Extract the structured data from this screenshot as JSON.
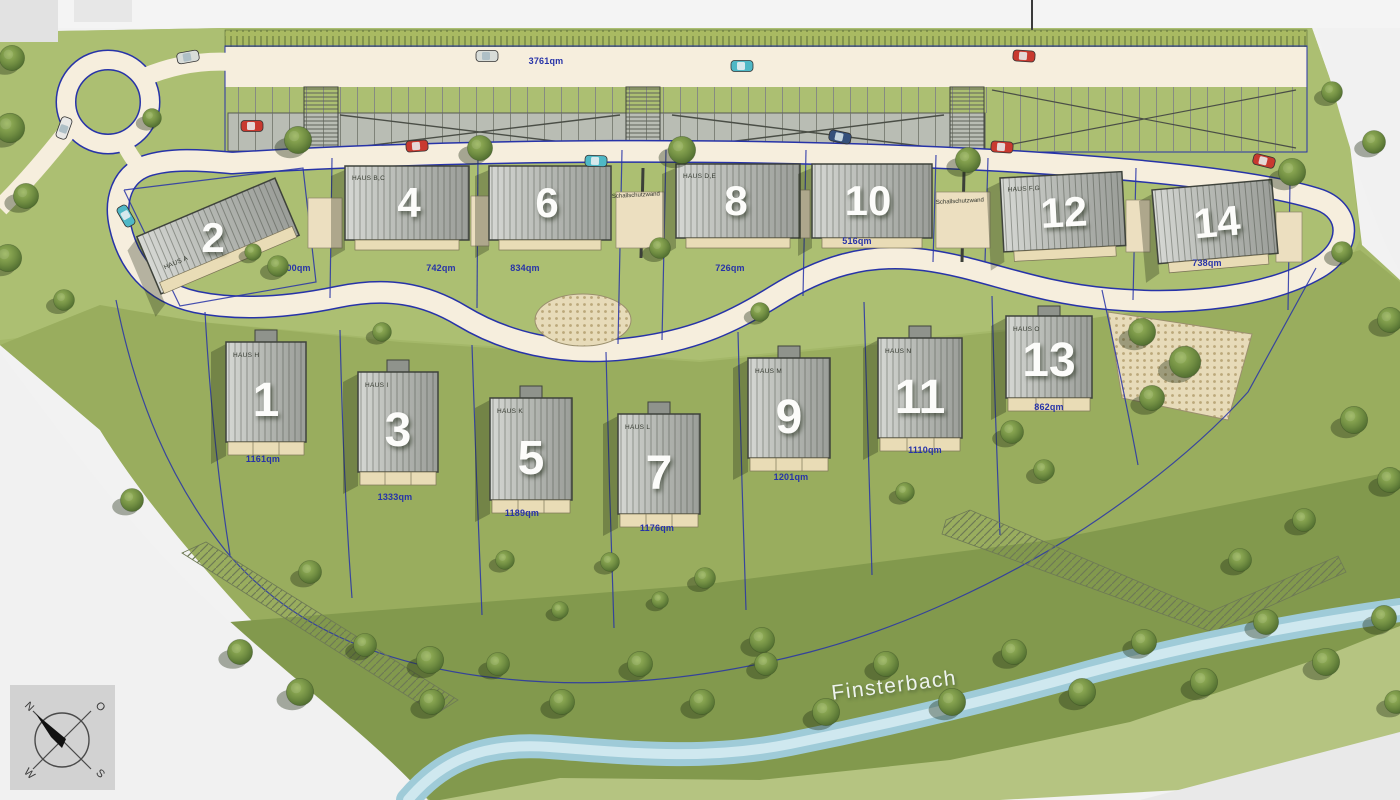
{
  "plan": {
    "parking_area": "3761qm",
    "stream_name": "Finsterbach",
    "noise_wall_1": "Schallschutzwand",
    "noise_wall_2": "Schallschutzwand"
  },
  "compass": {
    "north": "N",
    "east": "O",
    "south": "S",
    "west": "W"
  },
  "houses_upper": [
    {
      "number": "2",
      "name": "HAUS A",
      "area": "700qm"
    },
    {
      "number": "4",
      "name": "HAUS B,C",
      "area": "742qm"
    },
    {
      "number": "6",
      "name": "",
      "area": "834qm"
    },
    {
      "number": "8",
      "name": "HAUS D,E",
      "area": "726qm"
    },
    {
      "number": "10",
      "name": "",
      "area": "516qm"
    },
    {
      "number": "12",
      "name": "HAUS F,G",
      "area": ""
    },
    {
      "number": "14",
      "name": "",
      "area": "738qm"
    }
  ],
  "houses_lower": [
    {
      "number": "1",
      "name": "HAUS H",
      "area": "1161qm"
    },
    {
      "number": "3",
      "name": "HAUS I",
      "area": "1333qm"
    },
    {
      "number": "5",
      "name": "HAUS K",
      "area": "1189qm"
    },
    {
      "number": "7",
      "name": "HAUS L",
      "area": "1176qm"
    },
    {
      "number": "9",
      "name": "HAUS M",
      "area": "1201qm"
    },
    {
      "number": "11",
      "name": "HAUS N",
      "area": "1110qm"
    },
    {
      "number": "13",
      "name": "HAUS O",
      "area": "862qm"
    }
  ],
  "colors": {
    "grass": "#a4b869",
    "grass_dark": "#82994d",
    "road": "#f6eedd",
    "parcel_line": "#2733a8",
    "roof": "#b9bdb4",
    "water": "#a5cfdc",
    "label_blue": "#2733a8"
  }
}
